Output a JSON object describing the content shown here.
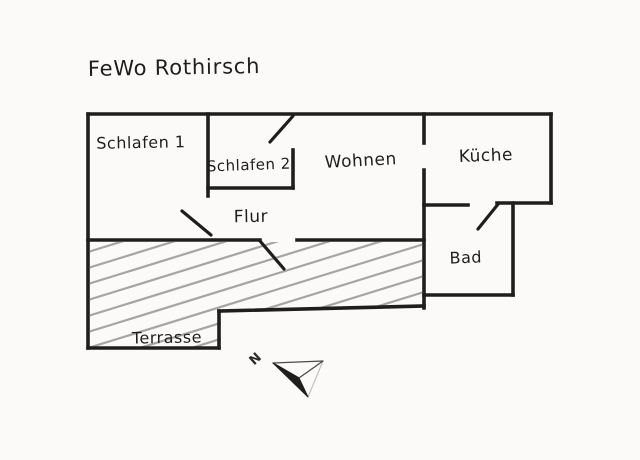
{
  "title": "FeWo Rothirsch",
  "rooms": {
    "schlafen1": "Schlafen 1",
    "schlafen2": "Schlafen 2",
    "wohnen": "Wohnen",
    "kueche": "Küche",
    "flur": "Flur",
    "bad": "Bad",
    "terrasse": "Terrasse"
  },
  "compass": {
    "north_label": "N"
  },
  "colors": {
    "ink": "#1e1e1c",
    "paper": "#fbfaf8",
    "hatch": "#a5a5a5"
  }
}
